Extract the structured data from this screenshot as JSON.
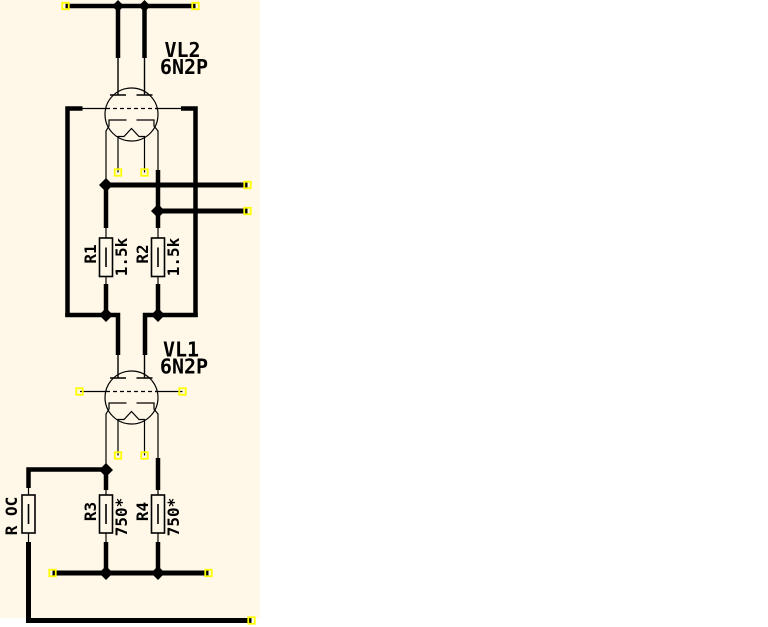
{
  "schematic": {
    "components": {
      "tubes": [
        {
          "ref": "VL2",
          "type": "6N2P"
        },
        {
          "ref": "VL1",
          "type": "6N2P"
        }
      ],
      "resistors": [
        {
          "ref": "R1",
          "value": "1.5k"
        },
        {
          "ref": "R2",
          "value": "1.5k"
        },
        {
          "ref": "R3",
          "value": "750*"
        },
        {
          "ref": "R4",
          "value": "750*"
        },
        {
          "ref": "R OC",
          "value": ""
        }
      ]
    },
    "colors": {
      "canvas_bg": "#FFF8E8",
      "wire": "#000000",
      "pin_marker": "#FFFF00",
      "junction": "#000000"
    }
  }
}
